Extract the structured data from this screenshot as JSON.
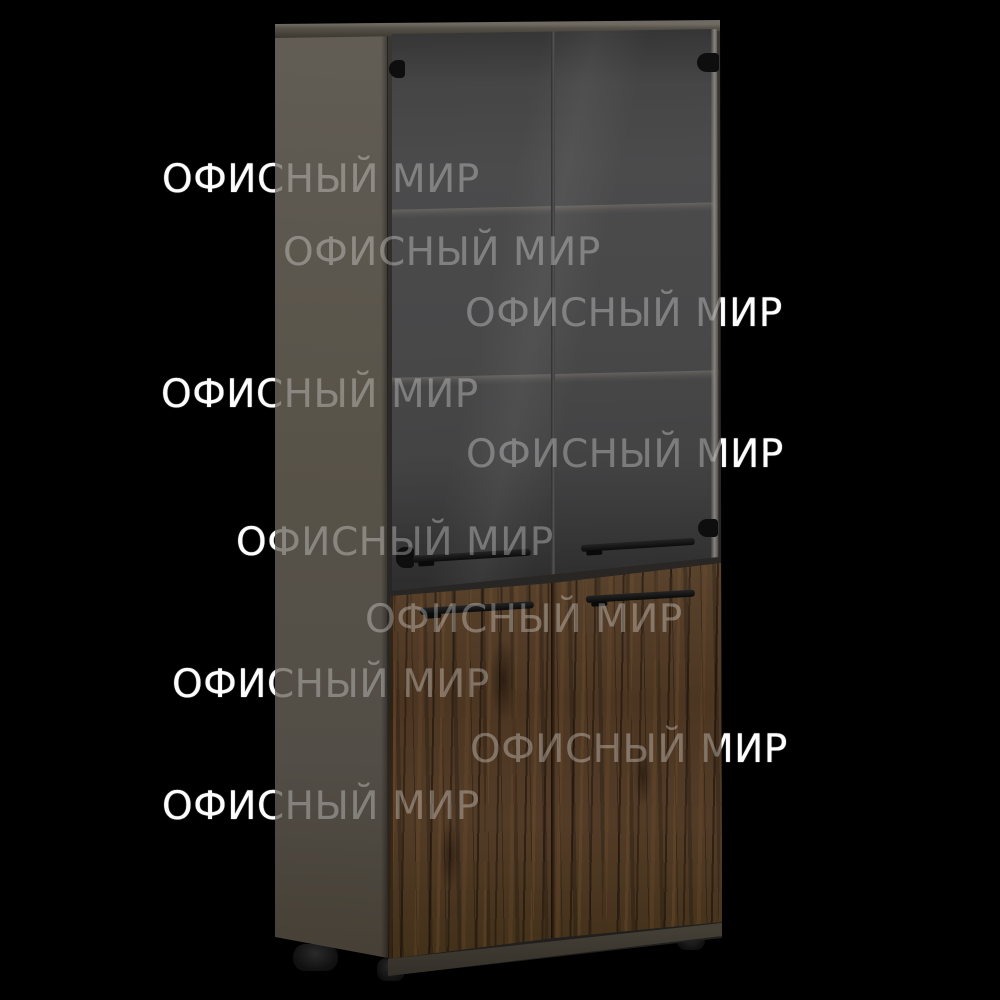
{
  "watermark": {
    "text": "ОФИСНЫЙ МИР",
    "rows": [
      {
        "x": 162,
        "y": 160
      },
      {
        "x": 283,
        "y": 233
      },
      {
        "x": 465,
        "y": 294
      },
      {
        "x": 161,
        "y": 375
      },
      {
        "x": 466,
        "y": 435
      },
      {
        "x": 236,
        "y": 523
      },
      {
        "x": 365,
        "y": 600
      },
      {
        "x": 172,
        "y": 665
      },
      {
        "x": 470,
        "y": 730
      },
      {
        "x": 162,
        "y": 787
      }
    ]
  },
  "palette": {
    "background": "#000000",
    "watermark": "#ffffff",
    "cabinet-side": "#575249",
    "cabinet-top": "#56524a",
    "glass-door": "#474747",
    "wood-door": "#4c3622",
    "plinth": "#3b3730",
    "hardware": "#0e0e0e"
  }
}
